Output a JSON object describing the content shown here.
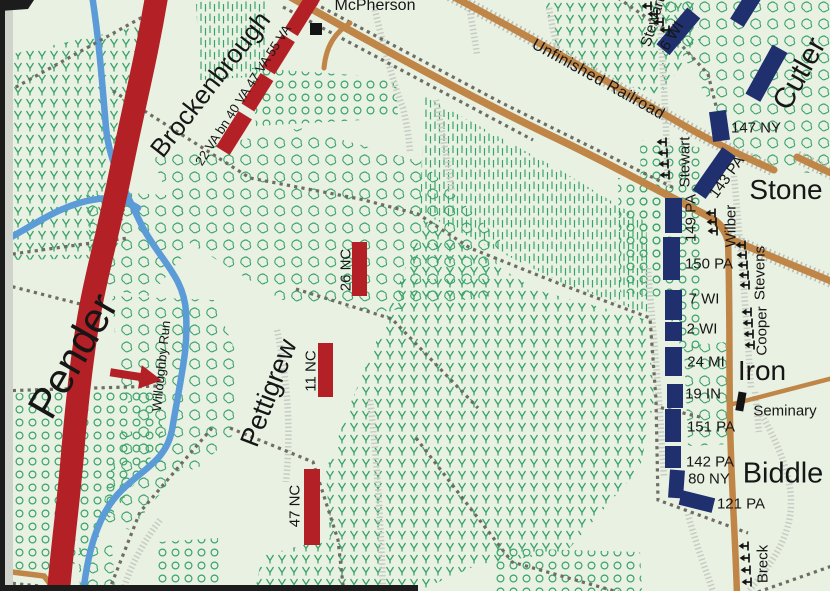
{
  "colors": {
    "background": "#e9f1e3",
    "confederate": "#b32025",
    "union": "#20306e",
    "road": "#c08647",
    "stream": "#5a9bd8",
    "tree": "#3aa36a",
    "fence": "#6e6d64",
    "hachure": "#c7ccc4"
  },
  "labels": {
    "places": {
      "mcpherson": "McPherson",
      "seminary": "Seminary",
      "willoughby_run": "Willoughby Run",
      "unfinished_railroad": "Unfinished Railroad"
    },
    "confederate": {
      "pender": "Pender",
      "brockenbrough": "Brockenbrough",
      "pettigrew": "Pettigrew",
      "va_line": "22 VA bn 40 VA 47 VA 55 VA",
      "nc26": "26 NC",
      "nc11": "11 NC",
      "nc47": "47 NC"
    },
    "union": {
      "cutler": "Cutler",
      "stone": "Stone",
      "iron": "Iron",
      "biddle": "Biddle",
      "wi6": "6 WI",
      "ny147": "147 NY",
      "pa143": "143 PA",
      "pa149": "149 PA",
      "pa150": "150 PA",
      "wi7": "7 WI",
      "wi2": "2 WI",
      "mi24": "24 MI",
      "in19": "19 IN",
      "pa151": "151 PA",
      "pa142": "142 PA",
      "ny80": "80 NY",
      "pa121": "121 PA",
      "stewart_n": "Stewart",
      "stewart_s": "Stewart",
      "wilber": "Wilber",
      "stevens": "Stevens",
      "cooper": "Cooper",
      "breck": "Breck"
    }
  }
}
